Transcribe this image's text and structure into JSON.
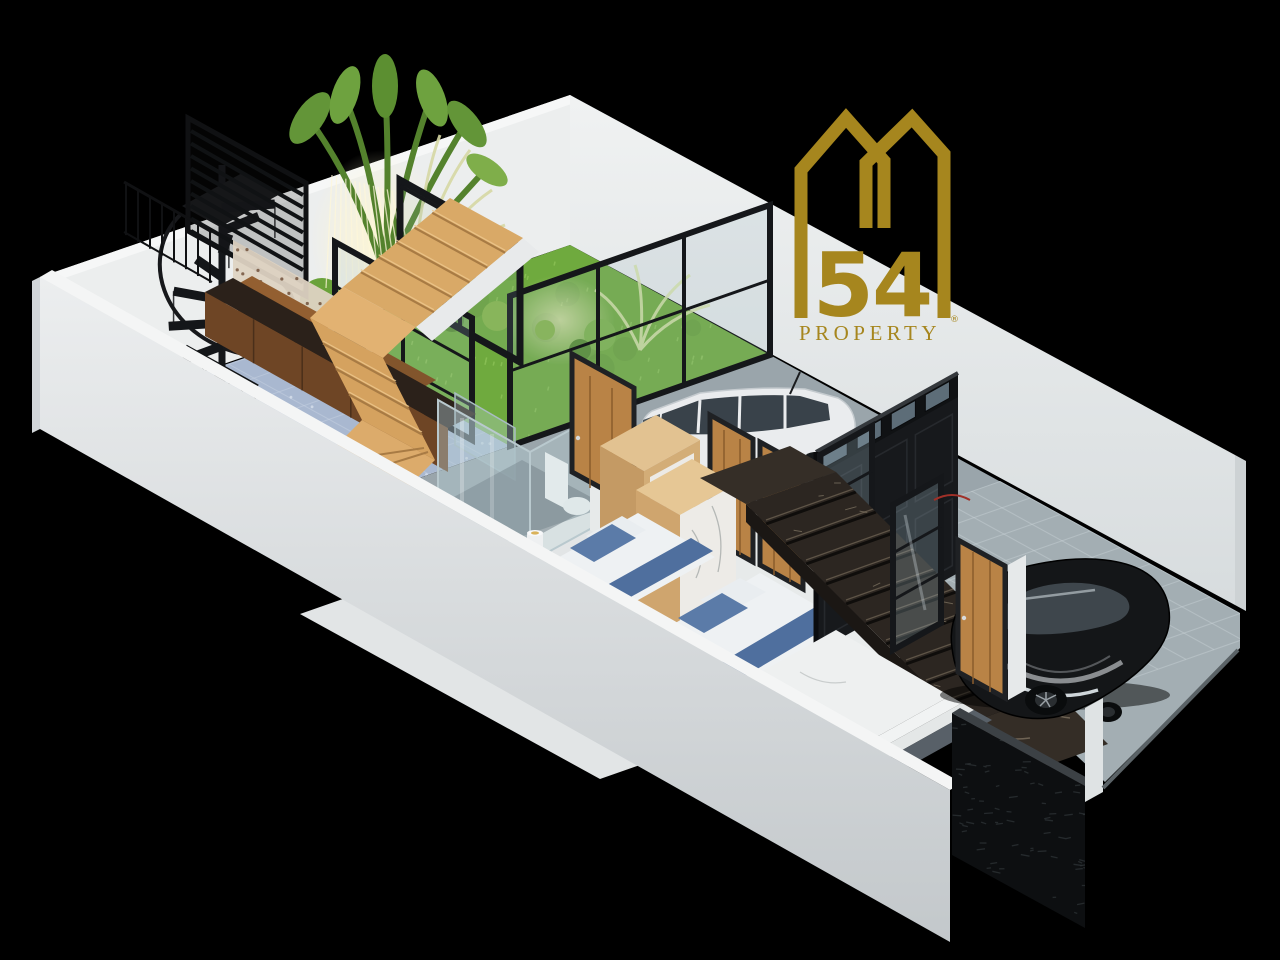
{
  "canvas": {
    "width": 1280,
    "height": 960,
    "background": "#000000"
  },
  "brand": {
    "number": "54",
    "name": "PROPERTY",
    "registered": "®",
    "gold": "#a6861e"
  },
  "scene": {
    "type": "isometric-3d-floor-plan-render",
    "rooms": [
      "garden-courtyard",
      "patio-blue-tile",
      "kitchen",
      "living-area",
      "bathroom",
      "bedroom-1",
      "bedroom-2",
      "corridor",
      "entry-foyer",
      "carport",
      "garage-driveway"
    ],
    "objects": [
      "spiral-staircase",
      "louver-screen",
      "wooden-staircase",
      "marble-staircase",
      "kitchen-counter",
      "kitchen-upper-cabinet",
      "kitchen-sink",
      "toilet",
      "wardrobe-1",
      "wardrobe-2",
      "bed-1",
      "bed-2",
      "black-facade-wall",
      "glass-partitions",
      "wooden-doors",
      "white-minivan",
      "black-sedan",
      "stone-fence",
      "tropical-plants",
      "string-lights"
    ],
    "palette": {
      "background": "#000000",
      "brand_gold": "#a6861e",
      "wall_white": "#e9ebec",
      "wall_shade": "#c6cbce",
      "floor_concrete": "#9aa5ab",
      "floor_tile_blue": "#a9b8d0",
      "grass_green": "#6faa3e",
      "wood_light": "#d9a967",
      "wood_cabinet": "#7a4f28",
      "door_wood": "#b98346",
      "frame_black": "#17191c",
      "marble_dark": "#2c2621",
      "marble_white": "#eef0f0",
      "bed_blue": "#56749f",
      "car_white": "#eaecee",
      "car_black": "#141618"
    }
  }
}
